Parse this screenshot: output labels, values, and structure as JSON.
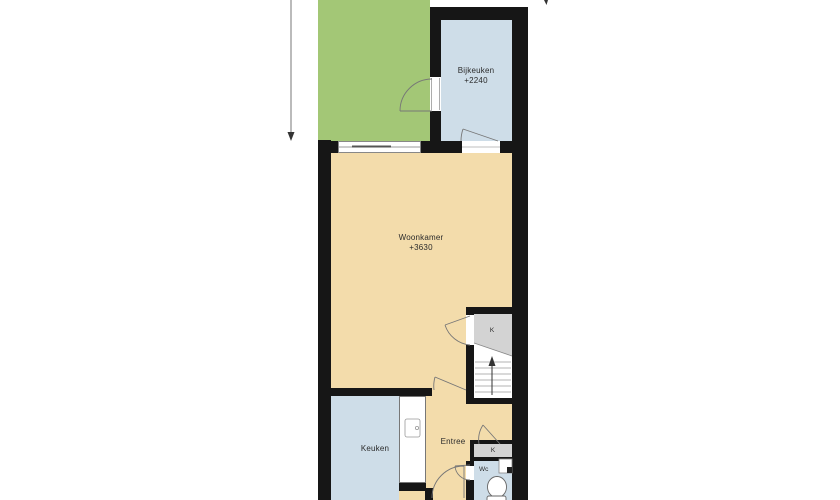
{
  "rooms": {
    "bijkeuken": {
      "label": "Bijkeuken",
      "ceiling": "+2240"
    },
    "woonkamer": {
      "label": "Woonkamer",
      "ceiling": "+3630"
    },
    "keuken": {
      "label": "Keuken"
    },
    "entree": {
      "label": "Entree"
    },
    "wc": {
      "label": "Wc"
    },
    "kast_trap": {
      "label": "K"
    },
    "kast_meter": {
      "label": "K"
    }
  },
  "colors": {
    "garden": "#a3c776",
    "floor": "#f3dcab",
    "wet": "#cedde8",
    "closet": "#d3d3d3",
    "wall": "#161616",
    "line": "#8a8a8a",
    "text": "#2b2b2b"
  },
  "icons": {
    "toilet": "toilet-icon",
    "hand_basin": "hand-basin-icon",
    "kitchen_sink": "kitchen-sink-icon",
    "stair_arrow": "stairs-up-arrow-icon",
    "north_mark": "north-arrow-tip-icon",
    "dimension": "dimension-arrow-icon",
    "door_swing": "door-swing-arc-icon"
  }
}
